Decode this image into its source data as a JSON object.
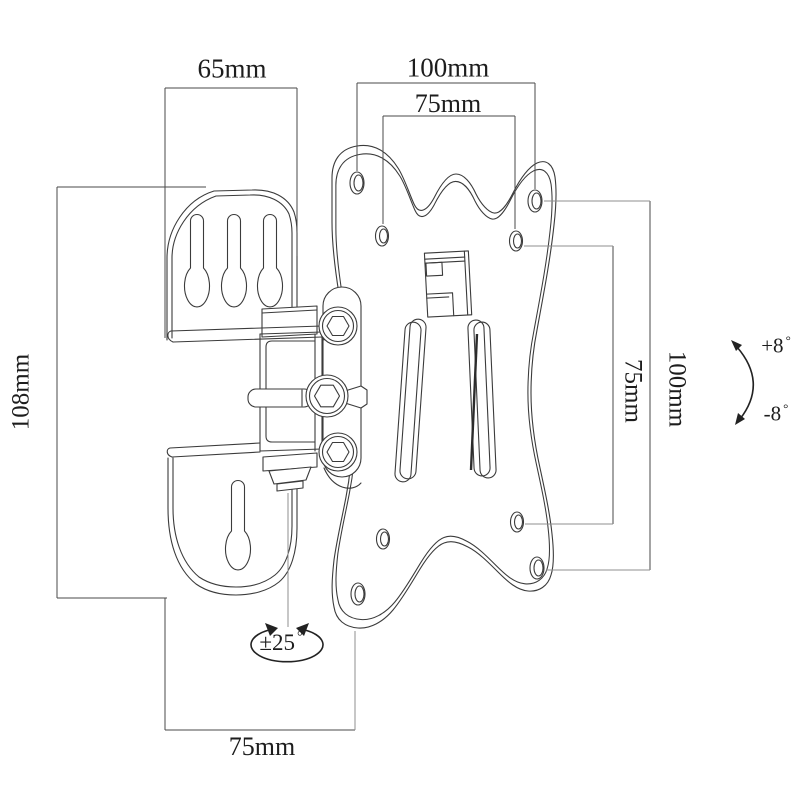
{
  "drawing": {
    "subject": "tilting TV wall mount bracket technical drawing",
    "labels": {
      "bracket_width_top": "65mm",
      "vesa_width_outer": "100mm",
      "vesa_width_inner": "75mm",
      "bracket_height_left": "108mm",
      "vesa_height_inner": "75mm",
      "vesa_height_outer": "100mm",
      "depth_bottom": "75mm",
      "tilt_up": "+8",
      "tilt_down": "-8",
      "swivel": "±25",
      "degree": "°"
    },
    "style": {
      "background": "#ffffff",
      "line_color": "#3b3b3b",
      "dimension_line_color": "#4a4a4a",
      "extension_line_color": "#8f8f8f",
      "text_color": "#1d1d1d"
    }
  }
}
